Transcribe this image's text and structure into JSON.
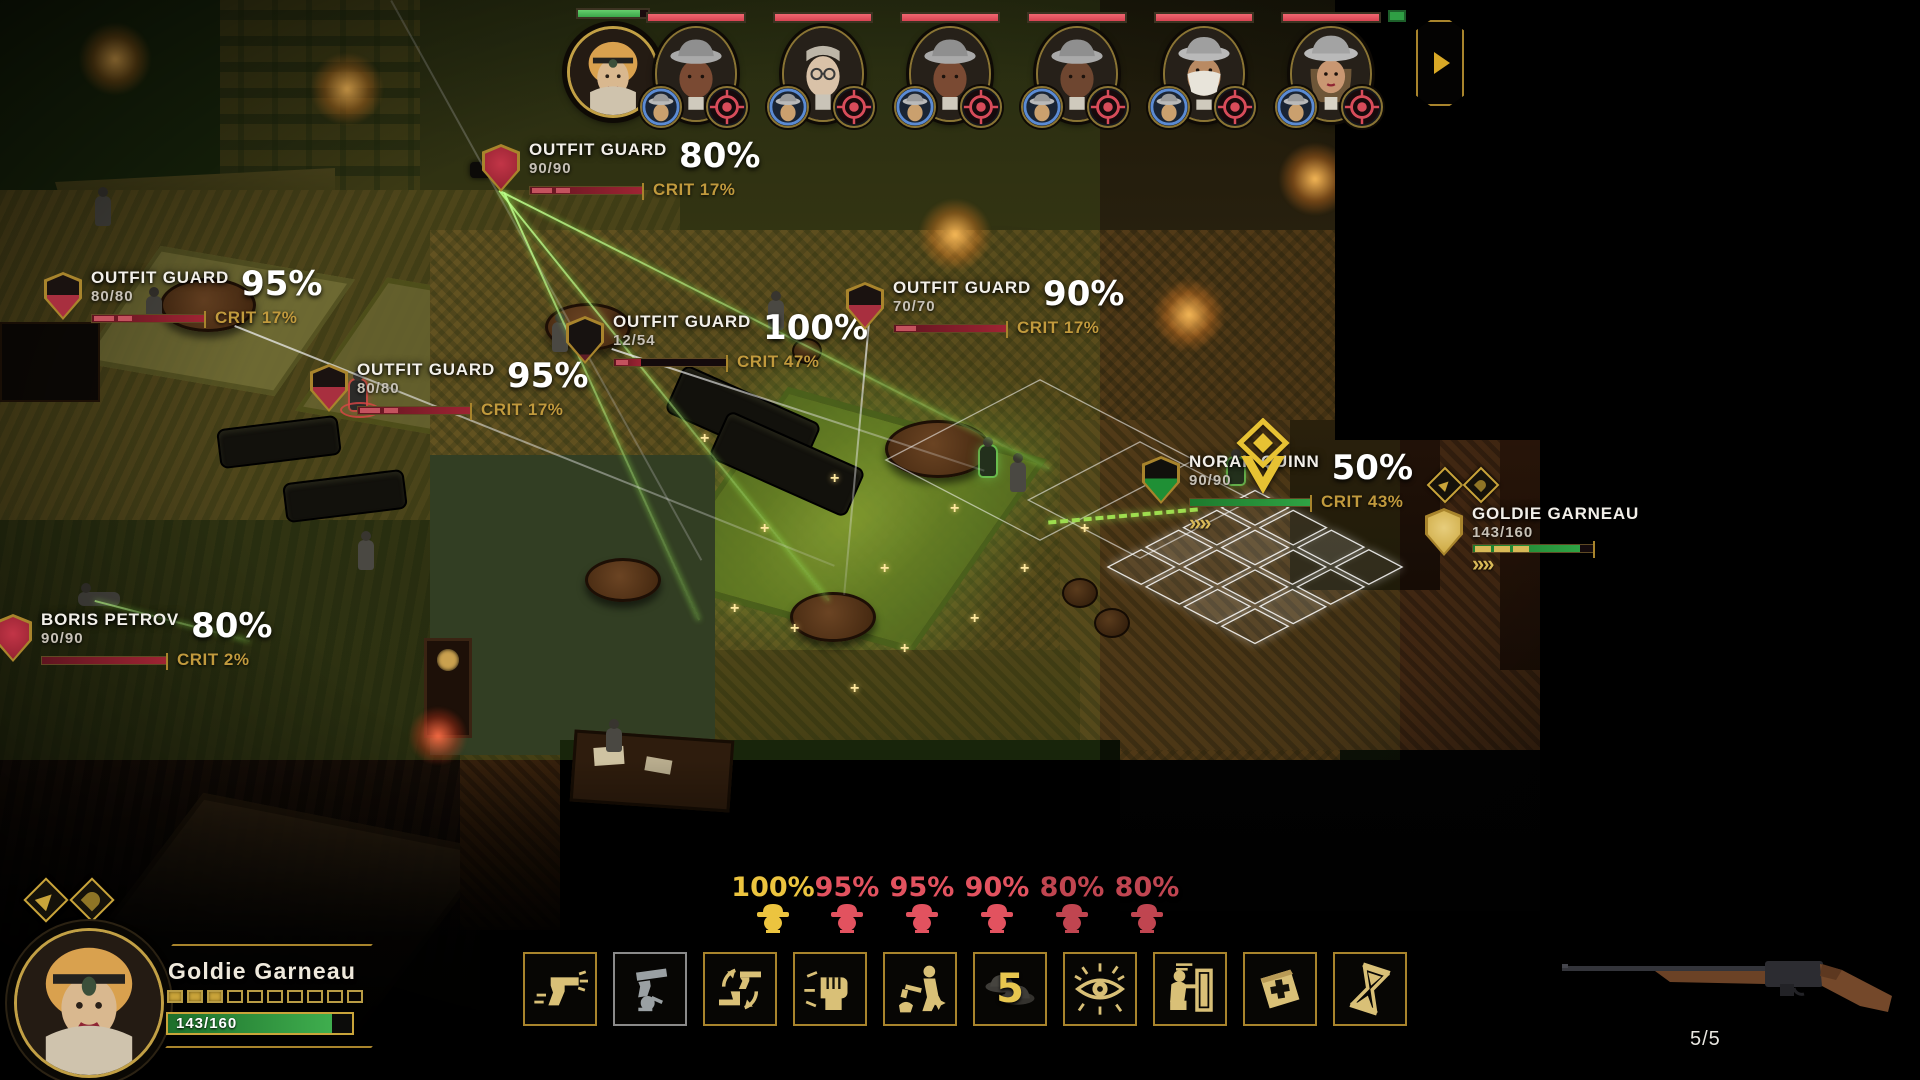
{
  "colors": {
    "gold": "#c9a43a",
    "crit_gold": "#c19a3d",
    "enemy_red": "#e2525f",
    "hp_red": "#9e2433",
    "ally_green": "#2fa344"
  },
  "party_bar": {
    "leader": {
      "name": "Goldie Garneau",
      "hp_percent": 88
    },
    "enemies": [
      {
        "type": "dark-man",
        "hp_percent": 100
      },
      {
        "type": "glasses-man",
        "hp_percent": 100
      },
      {
        "type": "dark-man",
        "hp_percent": 100
      },
      {
        "type": "dark-man",
        "hp_percent": 100
      },
      {
        "type": "masked-man",
        "hp_percent": 100
      },
      {
        "type": "hat-woman",
        "hp_percent": 100
      }
    ]
  },
  "unit_labels": [
    {
      "name": "OUTFIT GUARD",
      "hp": "90/90",
      "hit": "80%",
      "crit": "CRIT 17%"
    },
    {
      "name": "OUTFIT GUARD",
      "hp": "80/80",
      "hit": "95%",
      "crit": "CRIT 17%"
    },
    {
      "name": "OUTFIT GUARD",
      "hp": "80/80",
      "hit": "95%",
      "crit": "CRIT 17%"
    },
    {
      "name": "OUTFIT GUARD",
      "hp": "12/54",
      "hit": "100%",
      "crit": "CRIT 47%"
    },
    {
      "name": "OUTFIT GUARD",
      "hp": "70/70",
      "hit": "90%",
      "crit": "CRIT 17%"
    },
    {
      "name": "NORAH QUINN",
      "hp": "90/90",
      "hit": "50%",
      "crit": "CRIT 43%"
    },
    {
      "name": "GOLDIE GARNEAU",
      "hp": "143/160"
    },
    {
      "name": "BORIS PETROV",
      "hp": "90/90",
      "hit": "80%",
      "crit": "CRIT 2%"
    }
  ],
  "hit_chances": [
    {
      "value": "100%",
      "color": "gold"
    },
    {
      "value": "95%",
      "color": "red"
    },
    {
      "value": "95%",
      "color": "red"
    },
    {
      "value": "90%",
      "color": "red"
    },
    {
      "value": "80%",
      "color": "red"
    },
    {
      "value": "80%",
      "color": "red"
    }
  ],
  "ability_bar": {
    "slots": [
      {
        "label": "shoot"
      },
      {
        "label": "reload",
        "disabled": true
      },
      {
        "label": "swap-weapon"
      },
      {
        "label": "melee"
      },
      {
        "label": "execute"
      },
      {
        "label": "call-backup",
        "count": "5"
      },
      {
        "label": "overwatch"
      },
      {
        "label": "take-cover"
      },
      {
        "label": "first-aid"
      },
      {
        "label": "wait"
      }
    ]
  },
  "character_panel": {
    "name": "Goldie Garneau",
    "hp": "143/160",
    "pips_filled": 3,
    "pips_total": 10
  },
  "weapon_panel": {
    "ammo": "5/5"
  }
}
